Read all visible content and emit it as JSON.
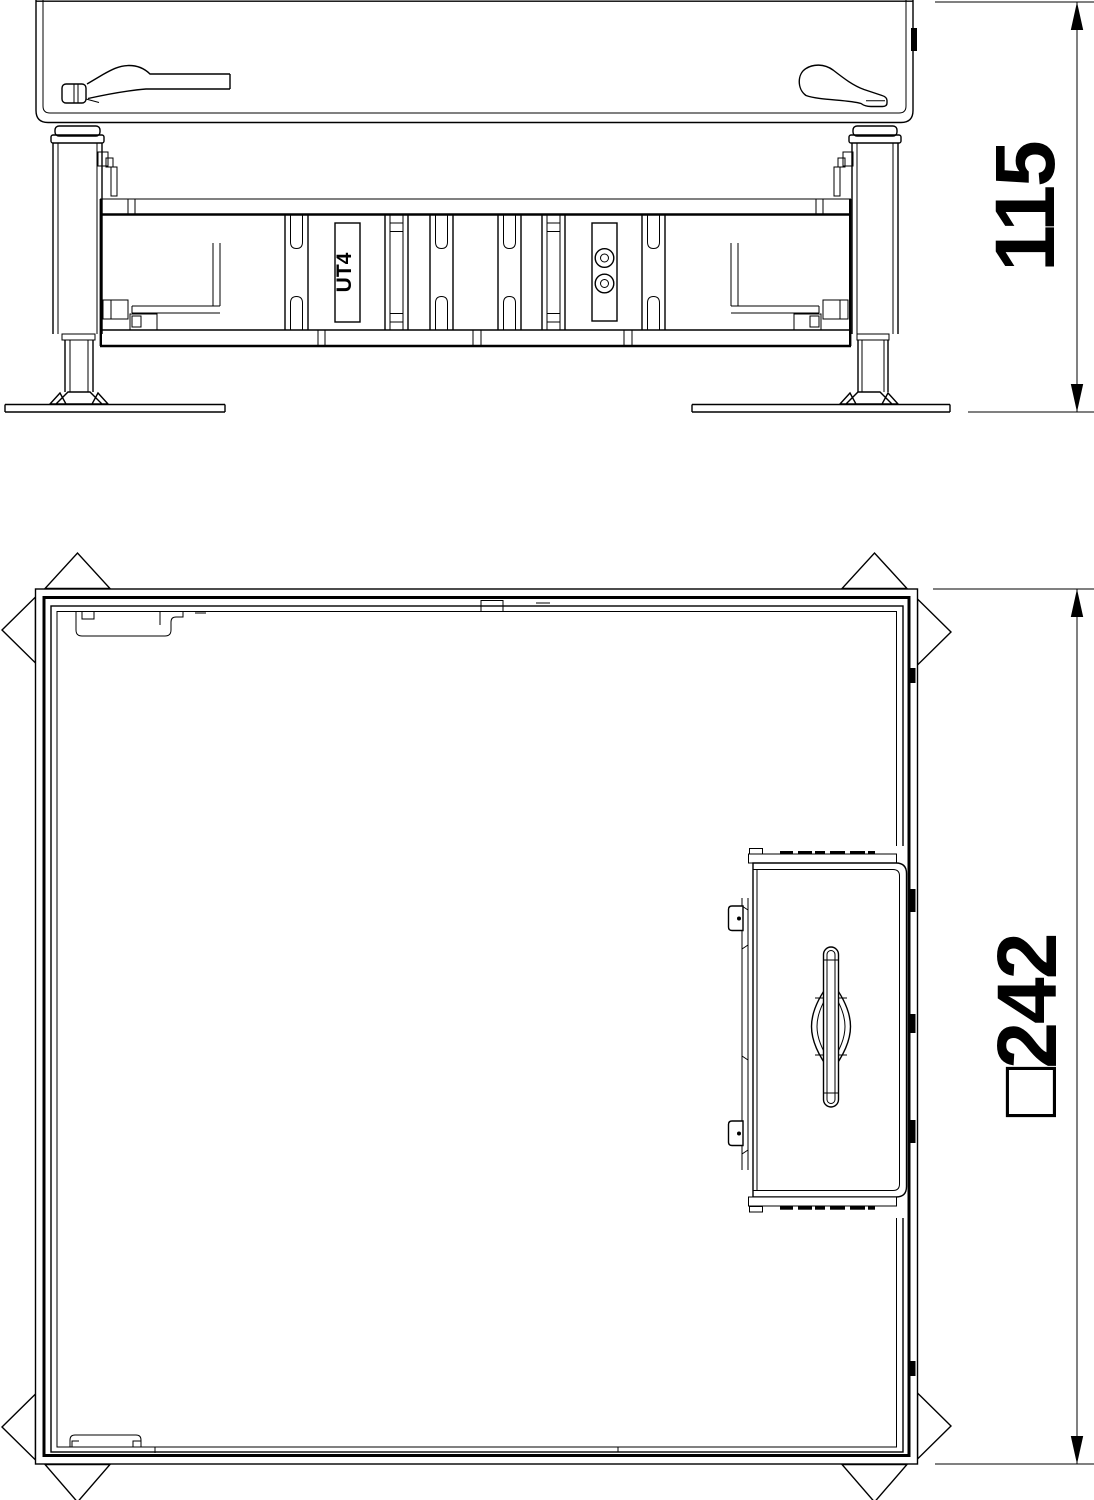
{
  "page": {
    "background": "#ffffff",
    "line_color": "#000000"
  },
  "views": {
    "side_elevation": {
      "name": "side-elevation-view",
      "component_label": "UT4"
    },
    "plan": {
      "name": "plan-view"
    }
  },
  "dimensions": {
    "height_mm": "115",
    "square_size_mm": "□242"
  }
}
